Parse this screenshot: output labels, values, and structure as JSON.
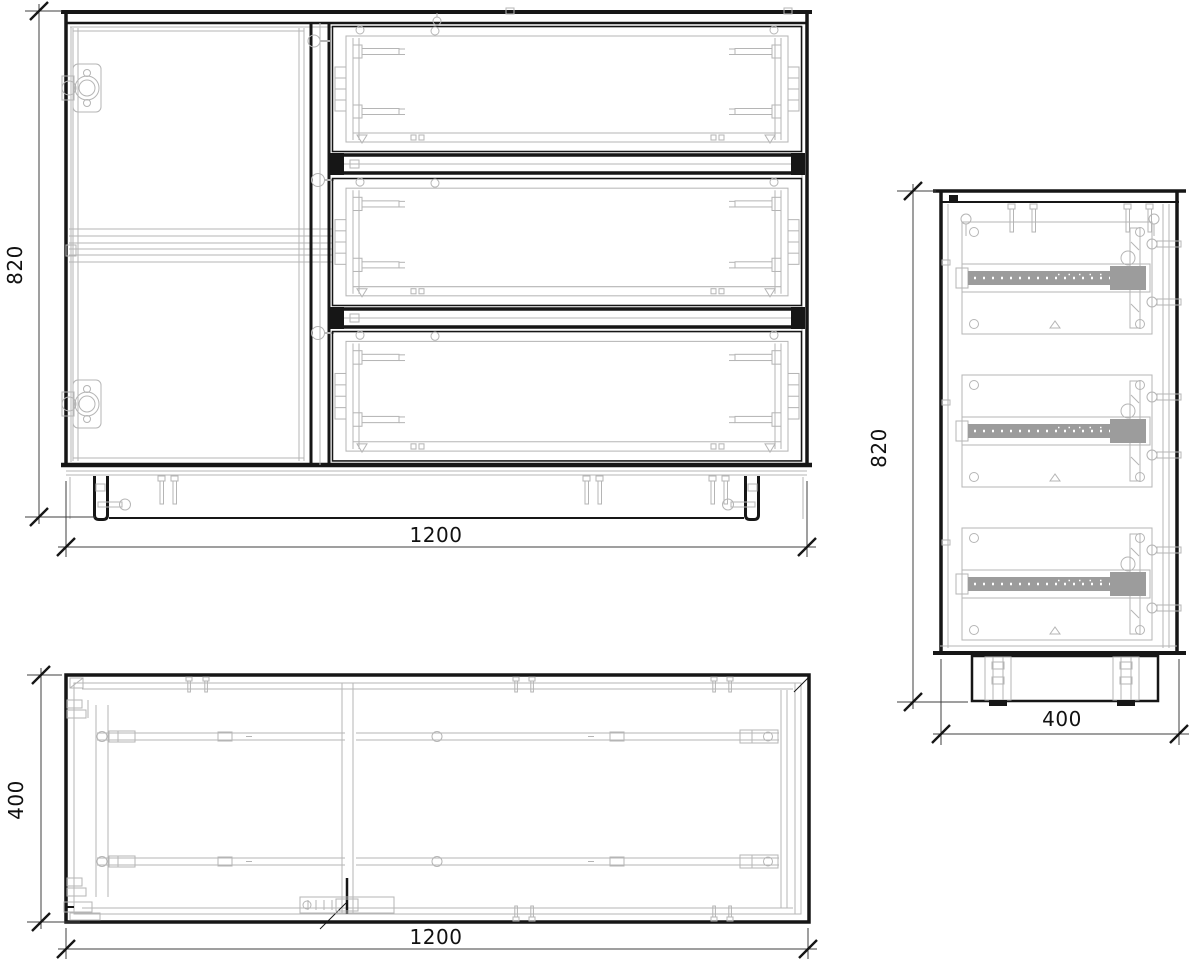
{
  "drawing": {
    "front_view": {
      "width_label": "1200",
      "height_label": "820"
    },
    "side_view": {
      "height_label": "820",
      "depth_label": "400"
    },
    "plan_view": {
      "width_label": "1200",
      "depth_label": "400"
    }
  },
  "colors": {
    "outline": "#161616",
    "hardware": "#b5b5b5",
    "dimension_line": "#3f3f3f",
    "text": "#111111",
    "background": "#ffffff"
  }
}
